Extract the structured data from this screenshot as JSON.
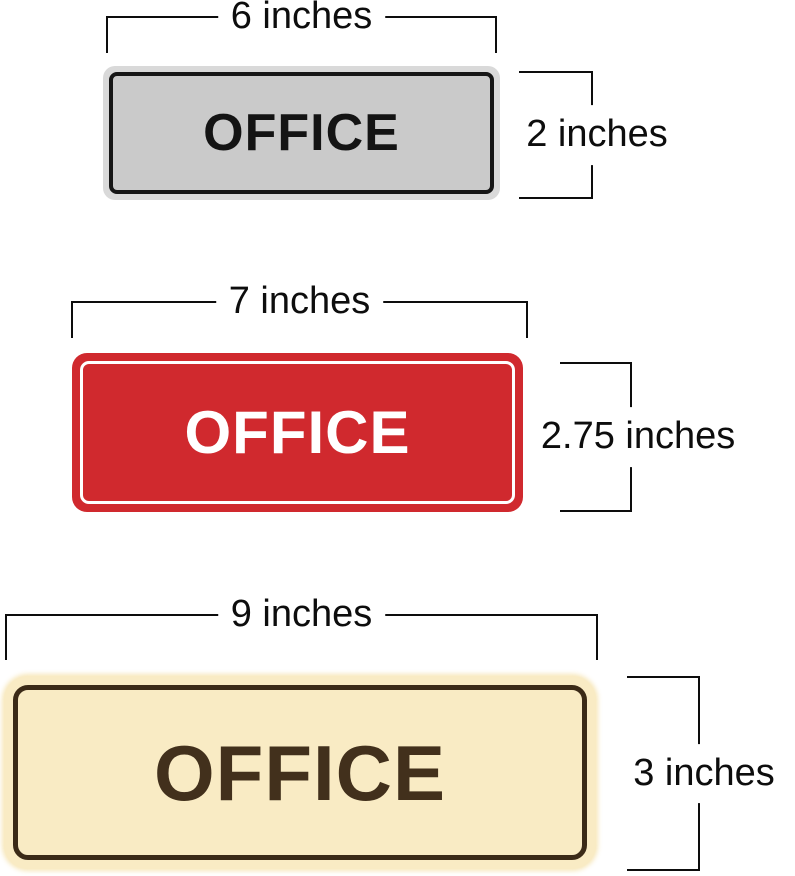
{
  "figure": {
    "background": "#ffffff",
    "dimension_color": "#0d0d0d"
  },
  "signs": [
    {
      "id": "gray-office-sign",
      "label": "OFFICE",
      "width_label": "6 inches",
      "height_label": "2 inches",
      "colors": {
        "rim": "#d9d9d9",
        "face": "#cacaca",
        "border": "#161616",
        "text": "#141414"
      }
    },
    {
      "id": "red-office-sign",
      "label": "OFFICE",
      "width_label": "7 inches",
      "height_label": "2.75 inches",
      "colors": {
        "rim": "#d0292e",
        "face": "#d0292e",
        "border": "#ffffff",
        "text": "#ffffff"
      }
    },
    {
      "id": "cream-office-sign",
      "label": "OFFICE",
      "width_label": "9 inches",
      "height_label": "3 inches",
      "colors": {
        "rim": "#f9ebc4",
        "face": "#f9ebc4",
        "border": "#3b2a17",
        "text": "#42301c"
      }
    }
  ]
}
